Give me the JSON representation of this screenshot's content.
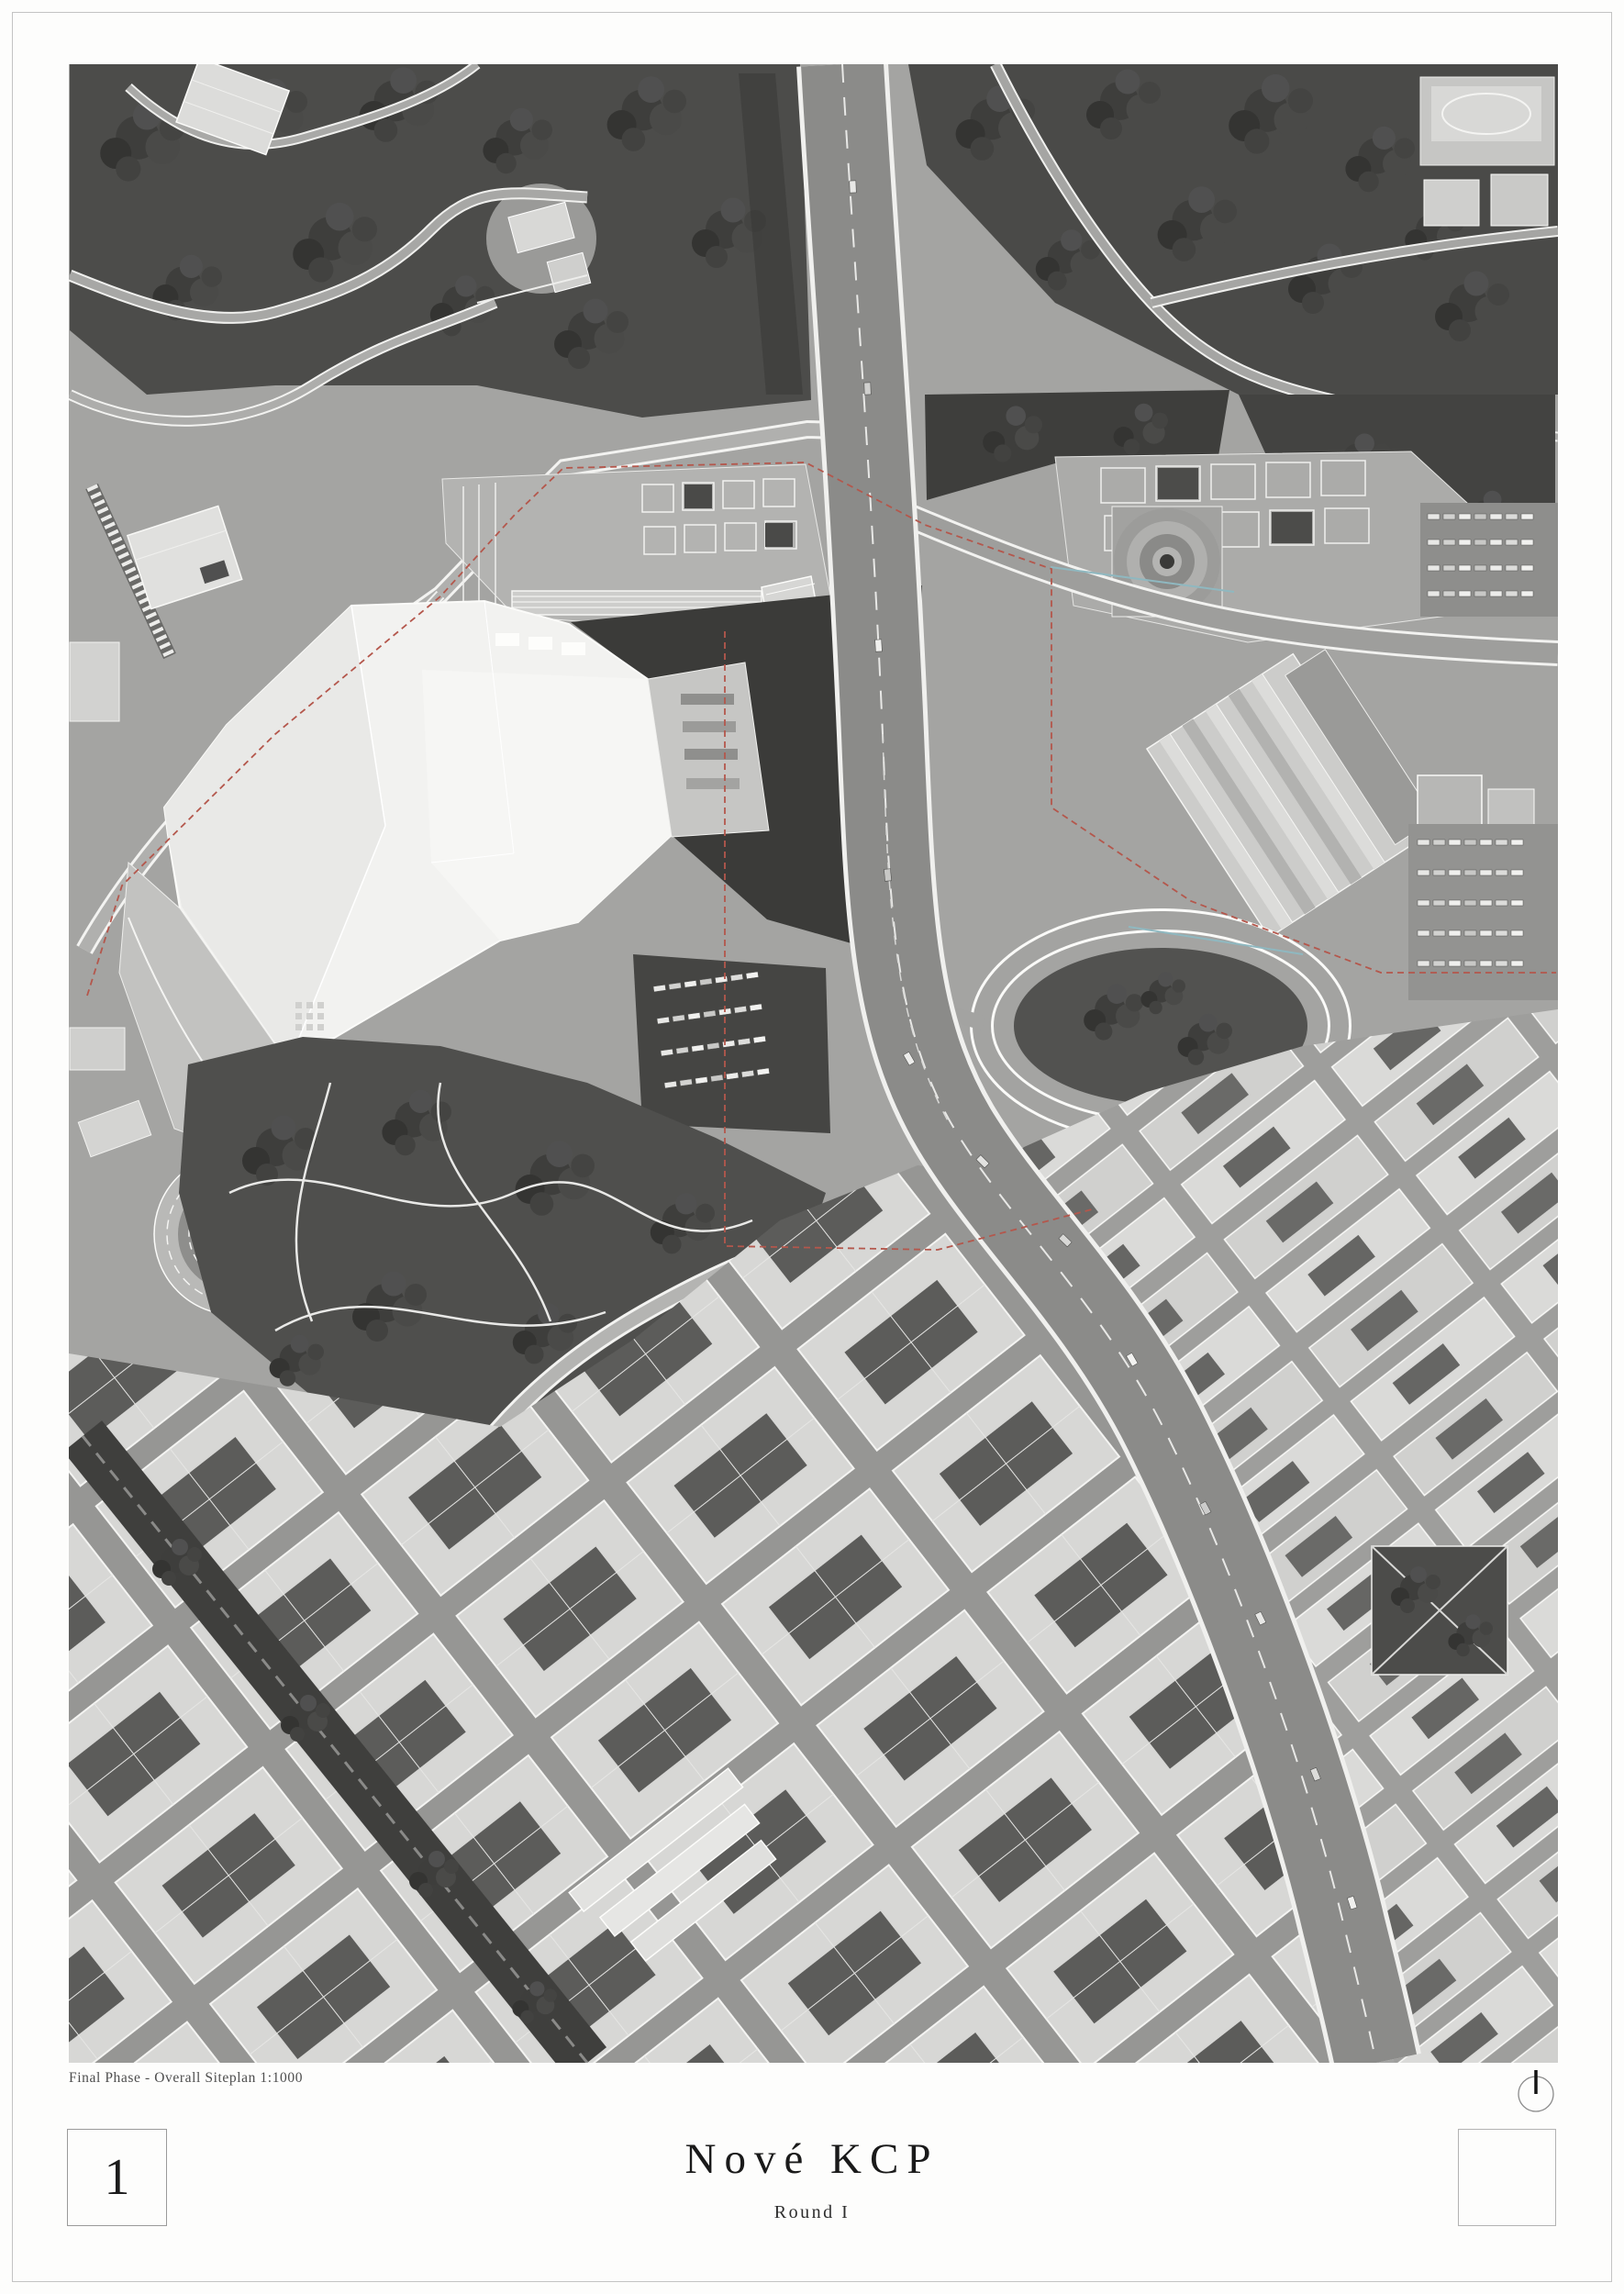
{
  "page": {
    "background": "#fdfdfc",
    "border_color": "#c3c3c3"
  },
  "map": {
    "caption": "Final Phase - Overall Siteplan 1:1000",
    "type": "grayscale-aerial-siteplan",
    "boundary_color": "#b4574c",
    "icons": {
      "north_arrow": "circle-with-north-tick"
    }
  },
  "title_block": {
    "sheet_number": "1",
    "title": "Nové KCP",
    "subtitle": "Round I"
  }
}
